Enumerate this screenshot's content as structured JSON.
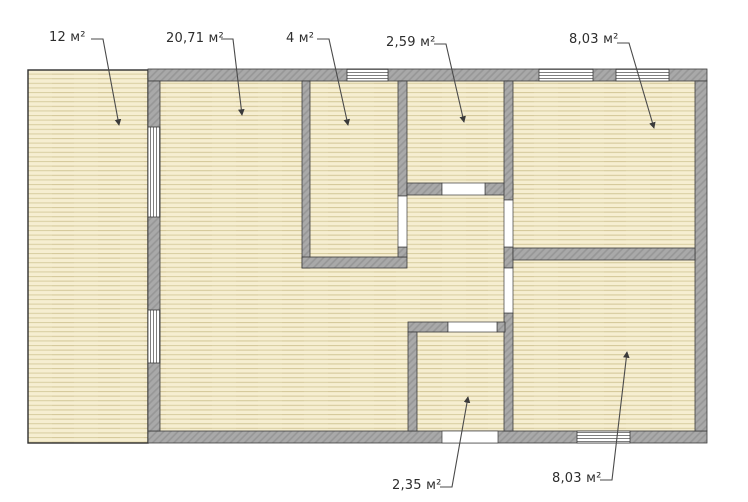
{
  "plan": {
    "type": "floor-plan",
    "labels": [
      {
        "id": "room-left-strip",
        "text": "12 м²"
      },
      {
        "id": "room-large-center",
        "text": "20,71 м²"
      },
      {
        "id": "room-small-top-mid",
        "text": "4 м²"
      },
      {
        "id": "room-hall-top",
        "text": "2,59 м²"
      },
      {
        "id": "room-top-right",
        "text": "8,03 м²"
      },
      {
        "id": "room-small-bottom",
        "text": "2,35 м²"
      },
      {
        "id": "room-bottom-right",
        "text": "8,03 м²"
      }
    ],
    "colors": {
      "background": "#ffffff",
      "floor": "#f6eed1",
      "floor_line": "#d9cea1",
      "wall": "#a9a9a9",
      "wall_hatch": "#969696",
      "outline": "#3b3b3b",
      "window": "#ffffff",
      "window_stripe": "#707070",
      "leader_line": "#4a4a4a",
      "label_text": "#2d2d2d"
    }
  }
}
